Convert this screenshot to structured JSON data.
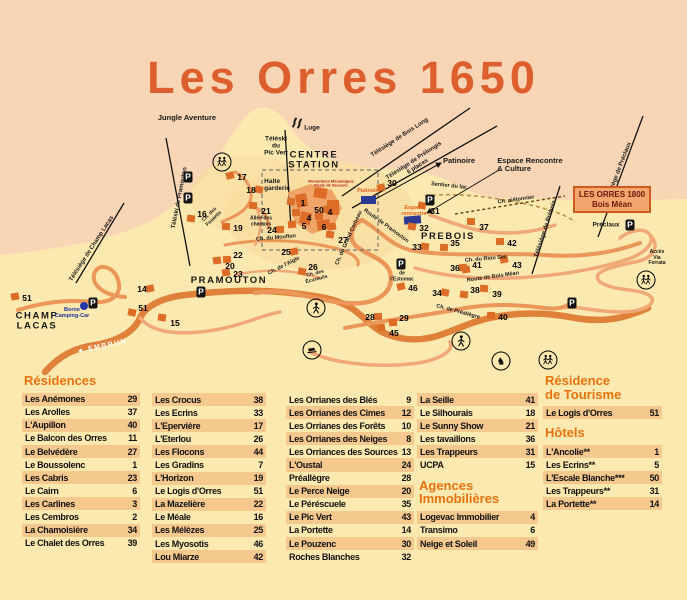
{
  "title": "Les Orres 1650",
  "colors": {
    "background_pink": "#f8d5b5",
    "background_yellow": "#fce9b0",
    "accent_orange": "#e8720e",
    "title_orange": "#dd5f2d",
    "road_orange": "#e0813a",
    "building_orange": "#dc6c26",
    "stripe": "#f5c88e",
    "rink_blue": "#2c3a94"
  },
  "map": {
    "orres_box": {
      "line1": "LES ORRES 1800",
      "line2": "Bois Méan"
    },
    "labels": [
      {
        "text": "Jungle Aventure",
        "x": 187,
        "y": 118,
        "r": 0,
        "cls": "poi"
      },
      {
        "text": "Téléski\ndu\nPic Vert",
        "x": 276,
        "y": 146,
        "r": 0,
        "cls": "small"
      },
      {
        "text": "CENTRE\nSTATION",
        "x": 314,
        "y": 161,
        "r": 0,
        "cls": "area"
      },
      {
        "text": "Halte\ngarderie",
        "x": 277,
        "y": 185,
        "r": 0,
        "cls": "small left"
      },
      {
        "text": "Luge",
        "x": 312,
        "y": 128,
        "r": 0,
        "cls": "small"
      },
      {
        "text": "Télésiège de Bois Long",
        "x": 400,
        "y": 138,
        "r": -33,
        "cls": "lift"
      },
      {
        "text": "Télésiège de Prélongis\n6 places",
        "x": 416,
        "y": 164,
        "r": -33,
        "cls": "lift"
      },
      {
        "text": "Patinoire",
        "x": 459,
        "y": 161,
        "r": 0,
        "cls": "poi"
      },
      {
        "text": "Sentier du lac",
        "x": 449,
        "y": 186,
        "r": 6,
        "cls": "road"
      },
      {
        "text": "Espace Rencontre\n& Culture",
        "x": 530,
        "y": 165,
        "r": 0,
        "cls": "poi left"
      },
      {
        "text": "Télésiège de Préclaux",
        "x": 619,
        "y": 172,
        "r": -69,
        "cls": "lift"
      },
      {
        "text": "Préclaux",
        "x": 606,
        "y": 225,
        "r": 0,
        "cls": "small"
      },
      {
        "text": "Télésiège de Prébois",
        "x": 546,
        "y": 229,
        "r": -72,
        "cls": "lift"
      },
      {
        "text": "Ch. piétonnier",
        "x": 516,
        "y": 200,
        "r": -8,
        "cls": "road"
      },
      {
        "text": "Accès\nVia\nFerrata",
        "x": 657,
        "y": 258,
        "r": 0,
        "cls": "tiny"
      },
      {
        "text": "PREBOIS",
        "x": 448,
        "y": 237,
        "r": 0,
        "cls": "area"
      },
      {
        "text": "PRAMOUTON",
        "x": 229,
        "y": 281,
        "r": 0,
        "cls": "area"
      },
      {
        "text": "CHAMP\nLACAS",
        "x": 37,
        "y": 322,
        "r": 0,
        "cls": "area"
      },
      {
        "text": "Téléski de Pramouton",
        "x": 180,
        "y": 198,
        "r": -79,
        "cls": "lift"
      },
      {
        "text": "Télésiège de Champ Lacas",
        "x": 92,
        "y": 249,
        "r": -57,
        "cls": "lift"
      },
      {
        "text": "Borne\nCamping-Car",
        "x": 72,
        "y": 313,
        "r": 0,
        "cls": "blue"
      },
      {
        "text": "◄ EMBRUN",
        "x": 102,
        "y": 347,
        "r": -12,
        "cls": "embrun"
      },
      {
        "text": "Ch. du Mouflon",
        "x": 276,
        "y": 238,
        "r": -5,
        "cls": "road"
      },
      {
        "text": "Allée des\nchamois",
        "x": 261,
        "y": 222,
        "r": 0,
        "cls": "tiny"
      },
      {
        "text": "Ch. des\nFouants",
        "x": 212,
        "y": 217,
        "r": -44,
        "cls": "tiny"
      },
      {
        "text": "Ch. de l'Aigle",
        "x": 284,
        "y": 266,
        "r": -27,
        "cls": "road"
      },
      {
        "text": "Ch. des\nÉcureuils",
        "x": 316,
        "y": 277,
        "r": -14,
        "cls": "tiny"
      },
      {
        "text": "Ch. du Grand Corbeau",
        "x": 349,
        "y": 238,
        "r": -66,
        "cls": "road"
      },
      {
        "text": "Route de Pramouton",
        "x": 386,
        "y": 226,
        "r": 36,
        "cls": "road"
      },
      {
        "text": "Ch. du Riou Sec",
        "x": 486,
        "y": 259,
        "r": -5,
        "cls": "road"
      },
      {
        "text": "Route de Bois Méan",
        "x": 493,
        "y": 277,
        "r": -8,
        "cls": "road"
      },
      {
        "text": "Ch. de Préallègre",
        "x": 458,
        "y": 312,
        "r": 15,
        "cls": "road"
      },
      {
        "text": "de\nl'Estomac",
        "x": 402,
        "y": 277,
        "r": 0,
        "cls": "tiny"
      },
      {
        "text": "Patinoire",
        "x": 369,
        "y": 191,
        "r": 0,
        "cls": "orange"
      },
      {
        "text": "Espace\nrencontre",
        "x": 414,
        "y": 211,
        "r": 0,
        "cls": "orange"
      },
      {
        "text": "Remontées Mécaniques\nPoste de Secours",
        "x": 331,
        "y": 184,
        "r": 0,
        "cls": "red"
      }
    ],
    "numbers": [
      {
        "n": "17",
        "x": 242,
        "y": 177
      },
      {
        "n": "18",
        "x": 251,
        "y": 190
      },
      {
        "n": "16",
        "x": 202,
        "y": 214
      },
      {
        "n": "21",
        "x": 266,
        "y": 211
      },
      {
        "n": "19",
        "x": 238,
        "y": 228
      },
      {
        "n": "24",
        "x": 272,
        "y": 230
      },
      {
        "n": "22",
        "x": 238,
        "y": 255
      },
      {
        "n": "20",
        "x": 230,
        "y": 266
      },
      {
        "n": "23",
        "x": 238,
        "y": 274
      },
      {
        "n": "25",
        "x": 286,
        "y": 252
      },
      {
        "n": "26",
        "x": 313,
        "y": 267
      },
      {
        "n": "27",
        "x": 343,
        "y": 240
      },
      {
        "n": "1",
        "x": 303,
        "y": 203
      },
      {
        "n": "50",
        "x": 319,
        "y": 210
      },
      {
        "n": "4",
        "x": 330,
        "y": 212
      },
      {
        "n": "4",
        "x": 309,
        "y": 218
      },
      {
        "n": "5",
        "x": 304,
        "y": 226
      },
      {
        "n": "6",
        "x": 324,
        "y": 227
      },
      {
        "n": "30",
        "x": 392,
        "y": 183
      },
      {
        "n": "31",
        "x": 435,
        "y": 211
      },
      {
        "n": "32",
        "x": 424,
        "y": 228
      },
      {
        "n": "33",
        "x": 417,
        "y": 247
      },
      {
        "n": "35",
        "x": 455,
        "y": 243
      },
      {
        "n": "37",
        "x": 484,
        "y": 227
      },
      {
        "n": "42",
        "x": 512,
        "y": 243
      },
      {
        "n": "36",
        "x": 455,
        "y": 268
      },
      {
        "n": "41",
        "x": 477,
        "y": 265
      },
      {
        "n": "43",
        "x": 517,
        "y": 265
      },
      {
        "n": "46",
        "x": 413,
        "y": 288
      },
      {
        "n": "34",
        "x": 437,
        "y": 293
      },
      {
        "n": "38",
        "x": 475,
        "y": 290
      },
      {
        "n": "39",
        "x": 497,
        "y": 294
      },
      {
        "n": "40",
        "x": 503,
        "y": 317
      },
      {
        "n": "28",
        "x": 370,
        "y": 317
      },
      {
        "n": "29",
        "x": 404,
        "y": 318
      },
      {
        "n": "45",
        "x": 394,
        "y": 333
      },
      {
        "n": "51",
        "x": 27,
        "y": 298
      },
      {
        "n": "14",
        "x": 142,
        "y": 289
      },
      {
        "n": "51",
        "x": 143,
        "y": 308
      },
      {
        "n": "15",
        "x": 175,
        "y": 323
      }
    ],
    "icons": [
      {
        "type": "hikers",
        "x": 222,
        "y": 162
      },
      {
        "type": "hikers",
        "x": 548,
        "y": 360
      },
      {
        "type": "hikers",
        "x": 646,
        "y": 280
      },
      {
        "type": "walker",
        "x": 316,
        "y": 308
      },
      {
        "type": "walker",
        "x": 461,
        "y": 341
      },
      {
        "type": "horse",
        "x": 501,
        "y": 361
      },
      {
        "type": "groomer",
        "x": 312,
        "y": 350
      },
      {
        "type": "parking",
        "x": 188,
        "y": 177
      },
      {
        "type": "parking",
        "x": 188,
        "y": 198
      },
      {
        "type": "parking",
        "x": 201,
        "y": 292
      },
      {
        "type": "parking",
        "x": 93,
        "y": 303
      },
      {
        "type": "parking",
        "x": 401,
        "y": 264
      },
      {
        "type": "parking",
        "x": 430,
        "y": 200
      },
      {
        "type": "parking",
        "x": 630,
        "y": 225
      },
      {
        "type": "parking",
        "x": 572,
        "y": 303
      },
      {
        "type": "camping",
        "x": 84,
        "y": 306
      },
      {
        "type": "luge",
        "x": 297,
        "y": 124
      }
    ]
  },
  "directory": {
    "columns": [
      {
        "blocks": [
          {
            "header": "Résidences",
            "items": [
              {
                "name": "Les Anémones",
                "num": "29"
              },
              {
                "name": "Les Arolles",
                "num": "37"
              },
              {
                "name": "L'Aupillon",
                "num": "40"
              },
              {
                "name": "Le Balcon des Orres",
                "num": "11"
              },
              {
                "name": "Le Belvédère",
                "num": "27"
              },
              {
                "name": "Le Boussolenc",
                "num": "1"
              },
              {
                "name": "Les Cabris",
                "num": "23"
              },
              {
                "name": "Le Cairn",
                "num": "6"
              },
              {
                "name": "Les Carlines",
                "num": "3"
              },
              {
                "name": "Les Cembros",
                "num": "2"
              },
              {
                "name": "La Chamoisière",
                "num": "34"
              },
              {
                "name": "Le Chalet des Orres",
                "num": "39"
              }
            ]
          }
        ]
      },
      {
        "blocks": [
          {
            "header": "",
            "items": [
              {
                "name": "Les Crocus",
                "num": "38"
              },
              {
                "name": "Les Ecrins",
                "num": "33"
              },
              {
                "name": "L'Epervière",
                "num": "17"
              },
              {
                "name": "L'Eterlou",
                "num": "26"
              },
              {
                "name": "Les Flocons",
                "num": "44"
              },
              {
                "name": "Les Gradins",
                "num": "7"
              },
              {
                "name": "L'Horizon",
                "num": "19"
              },
              {
                "name": "Le Logis d'Orres",
                "num": "51"
              },
              {
                "name": "La Mazelière",
                "num": "22"
              },
              {
                "name": "Le Méale",
                "num": "16"
              },
              {
                "name": "Les Mélèzes",
                "num": "25"
              },
              {
                "name": "Les Myosotis",
                "num": "46"
              },
              {
                "name": "Lou Miarze",
                "num": "42"
              }
            ]
          }
        ]
      },
      {
        "blocks": [
          {
            "header": "",
            "items": [
              {
                "name": "Les Orrianes des Blés",
                "num": "9"
              },
              {
                "name": "Les Orrianes des Cimes",
                "num": "12"
              },
              {
                "name": "Les Orrianes des Forêts",
                "num": "10"
              },
              {
                "name": "Les Orrianes des Neiges",
                "num": "8"
              },
              {
                "name": "Les Orriances des Sources",
                "num": "13"
              },
              {
                "name": "L'Oustal",
                "num": "24"
              },
              {
                "name": "Préallègre",
                "num": "28"
              },
              {
                "name": "Le Perce Neige",
                "num": "20"
              },
              {
                "name": "Le Péréscuele",
                "num": "35"
              },
              {
                "name": "Le Pic Vert",
                "num": "43"
              },
              {
                "name": "La Portette",
                "num": "14"
              },
              {
                "name": "Le Pouzenc",
                "num": "30"
              },
              {
                "name": "Roches Blanches",
                "num": "32"
              }
            ]
          }
        ]
      },
      {
        "blocks": [
          {
            "header": "",
            "items": [
              {
                "name": "La Seille",
                "num": "41"
              },
              {
                "name": "Le Silhourais",
                "num": "18"
              },
              {
                "name": "Le Sunny Show",
                "num": "21"
              },
              {
                "name": "Les tavaillons",
                "num": "36"
              },
              {
                "name": "Les Trappeurs",
                "num": "31"
              },
              {
                "name": "UCPA",
                "num": "15"
              }
            ]
          },
          {
            "header": "Agences\nImmobilières",
            "items": [
              {
                "name": "Logevac Immobilier",
                "num": "4"
              },
              {
                "name": "Transimo",
                "num": "6"
              },
              {
                "name": "Neige et Soleil",
                "num": "49"
              }
            ]
          }
        ]
      },
      {
        "blocks": [
          {
            "header": "Résidence\nde Tourisme",
            "items": [
              {
                "name": "Le Logis d'Orres",
                "num": "51"
              }
            ]
          },
          {
            "header": "Hôtels",
            "items": [
              {
                "name": "L'Ancolie**",
                "num": "1"
              },
              {
                "name": "Les Ecrins**",
                "num": "5"
              },
              {
                "name": "L'Escale Blanche***",
                "num": "50"
              },
              {
                "name": "Les Trappeurs**",
                "num": "31"
              },
              {
                "name": "La Portette**",
                "num": "14"
              }
            ]
          }
        ]
      }
    ]
  }
}
